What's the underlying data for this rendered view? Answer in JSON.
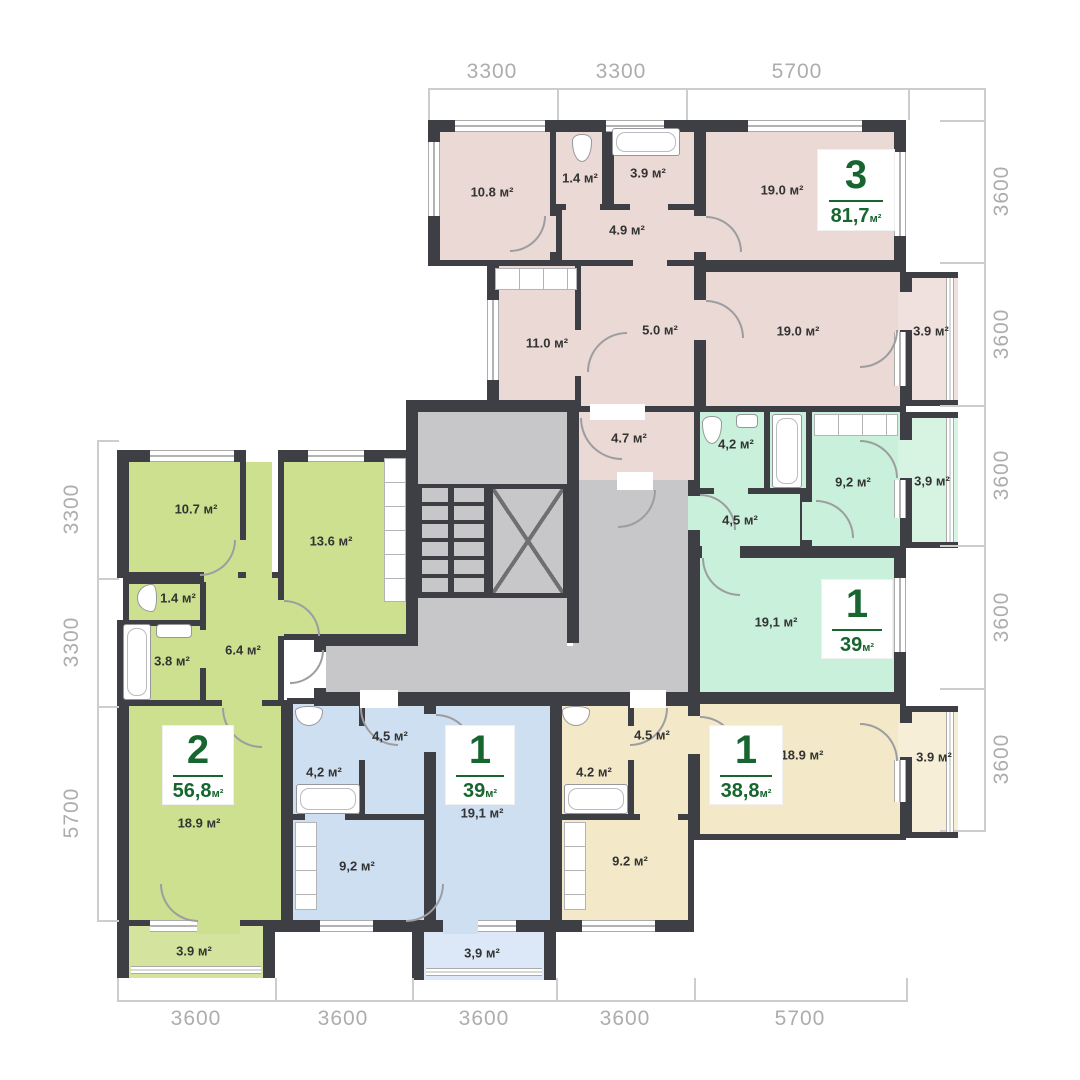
{
  "plan": {
    "dims": {
      "top": [
        "3300",
        "3300",
        "5700"
      ],
      "right": [
        "3600",
        "3600",
        "3600",
        "3600",
        "3600"
      ],
      "left": [
        "3300",
        "3300",
        "5700"
      ],
      "bottom": [
        "3600",
        "3600",
        "3600",
        "3600",
        "5700"
      ]
    },
    "apartments": {
      "pink": {
        "number": "3",
        "area": "81,7",
        "unit": "м²",
        "rooms": {
          "bedroom": "10.8 м²",
          "wc": "1.4 м²",
          "bath": "3.9 м²",
          "hall": "4.9 м²",
          "living_top": "19.0 м²",
          "kitchen": "11.0 м²",
          "hall2": "5.0 м²",
          "living_right": "19.0 м²",
          "balcony": "3.9 м²",
          "entry": "4.7 м²"
        }
      },
      "mint": {
        "number": "1",
        "area": "39",
        "unit": "м²",
        "rooms": {
          "wc": "4,2 м²",
          "kitchen": "9,2 м²",
          "balcony": "3,9 м²",
          "hall": "4,5 м²",
          "living": "19,1 м²"
        }
      },
      "green": {
        "number": "2",
        "area": "56,8",
        "unit": "м²",
        "rooms": {
          "bedroom": "10.7 м²",
          "kitchen": "13.6 м²",
          "wc": "1.4 м²",
          "bath": "3.8 м²",
          "hall": "6.4 м²",
          "living": "18.9 м²",
          "balcony": "3.9 м²"
        }
      },
      "blue": {
        "number": "1",
        "area": "39",
        "unit": "м²",
        "rooms": {
          "hall": "4,5 м²",
          "wc": "4,2 м²",
          "kitchen": "9,2 м²",
          "living": "19,1 м²",
          "balcony": "3,9 м²"
        }
      },
      "yellow": {
        "number": "1",
        "area": "38,8",
        "unit": "м²",
        "rooms": {
          "hall": "4.5 м²",
          "wc": "4.2 м²",
          "kitchen": "9.2 м²",
          "living": "18.9 м²",
          "balcony": "3.9 м²"
        }
      }
    },
    "colors": {
      "wall": "#3e3f44",
      "accent_green": "#17652f",
      "pink": "#ead9d5",
      "mint": "#c9f0da",
      "lime": "#cde08f",
      "blue": "#cfdff2",
      "yellow": "#f3e9c8",
      "stair_gray": "#c7c7c9",
      "dim_text": "#adadad"
    }
  }
}
